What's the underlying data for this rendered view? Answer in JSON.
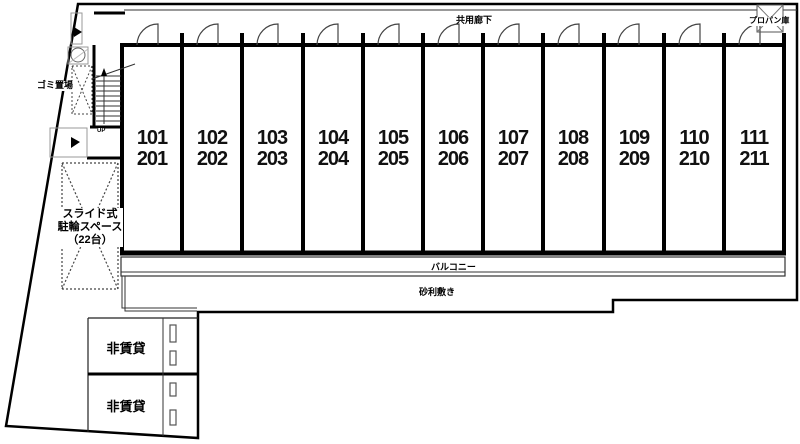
{
  "labels": {
    "corridor": "共用廊下",
    "propane": "プロパン庫",
    "garbage": "ゴミ置場",
    "up": "UP",
    "balcony": "バルコニー",
    "gravel": "砂利敷き",
    "nonrental_upper": "非賃貸",
    "nonrental_lower": "非賃貸",
    "bicycle_line1": "スライド式",
    "bicycle_line2": "駐輪スペース",
    "bicycle_line3": "（22台）"
  },
  "rooms": [
    {
      "first": "101",
      "second": "201"
    },
    {
      "first": "102",
      "second": "202"
    },
    {
      "first": "103",
      "second": "203"
    },
    {
      "first": "104",
      "second": "204"
    },
    {
      "first": "105",
      "second": "205"
    },
    {
      "first": "106",
      "second": "206"
    },
    {
      "first": "107",
      "second": "207"
    },
    {
      "first": "108",
      "second": "208"
    },
    {
      "first": "109",
      "second": "209"
    },
    {
      "first": "110",
      "second": "210"
    },
    {
      "first": "111",
      "second": "211"
    }
  ],
  "colors": {
    "line": "#000000",
    "thin_line": "#333333",
    "background": "#ffffff"
  }
}
